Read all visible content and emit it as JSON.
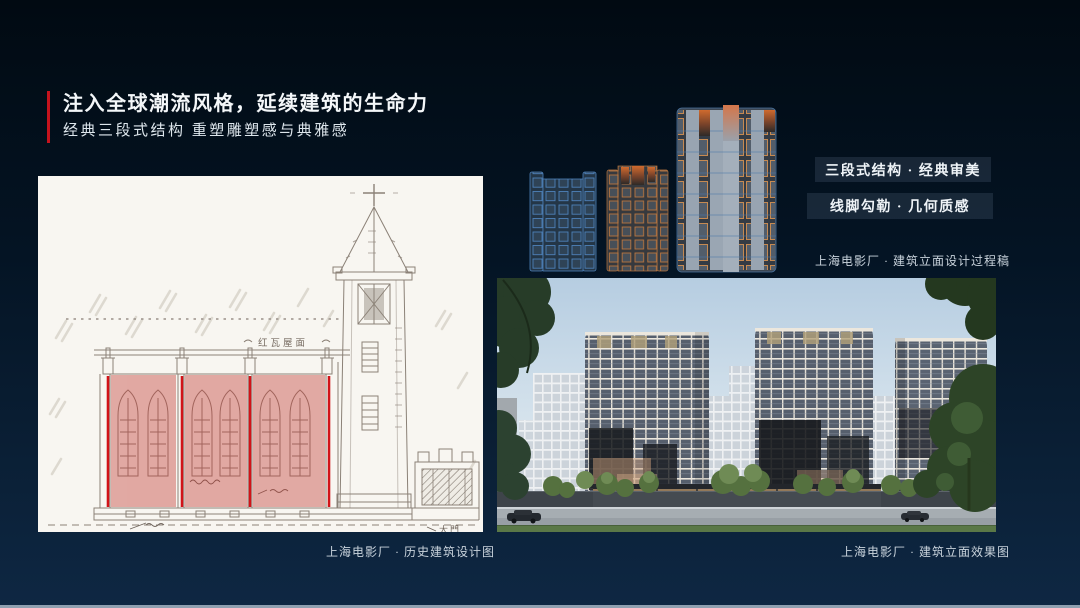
{
  "slide": {
    "title": "注入全球潮流风格，延续建筑的生命力",
    "subtitle": "经典三段式结构 重塑雕塑感与典雅感"
  },
  "tags": [
    {
      "label": "三段式结构 · 经典审美"
    },
    {
      "label": "线脚勾勒 · 几何质感"
    }
  ],
  "captions": {
    "historical": "上海电影厂 · 历史建筑设计图",
    "process": "上海电影厂 · 建筑立面设计过程稿",
    "render": "上海电影厂 · 建筑立面效果图"
  },
  "drawing_annotations": {
    "roof": "红瓦屋面",
    "gate": "大門"
  },
  "colors": {
    "accent_red": "#c5131d",
    "highlight_red": "rgba(194,62,56,0.42)",
    "background_top": "#010a12",
    "background_bottom": "#0e2743",
    "bottom_strip": "#8fa0b0"
  }
}
